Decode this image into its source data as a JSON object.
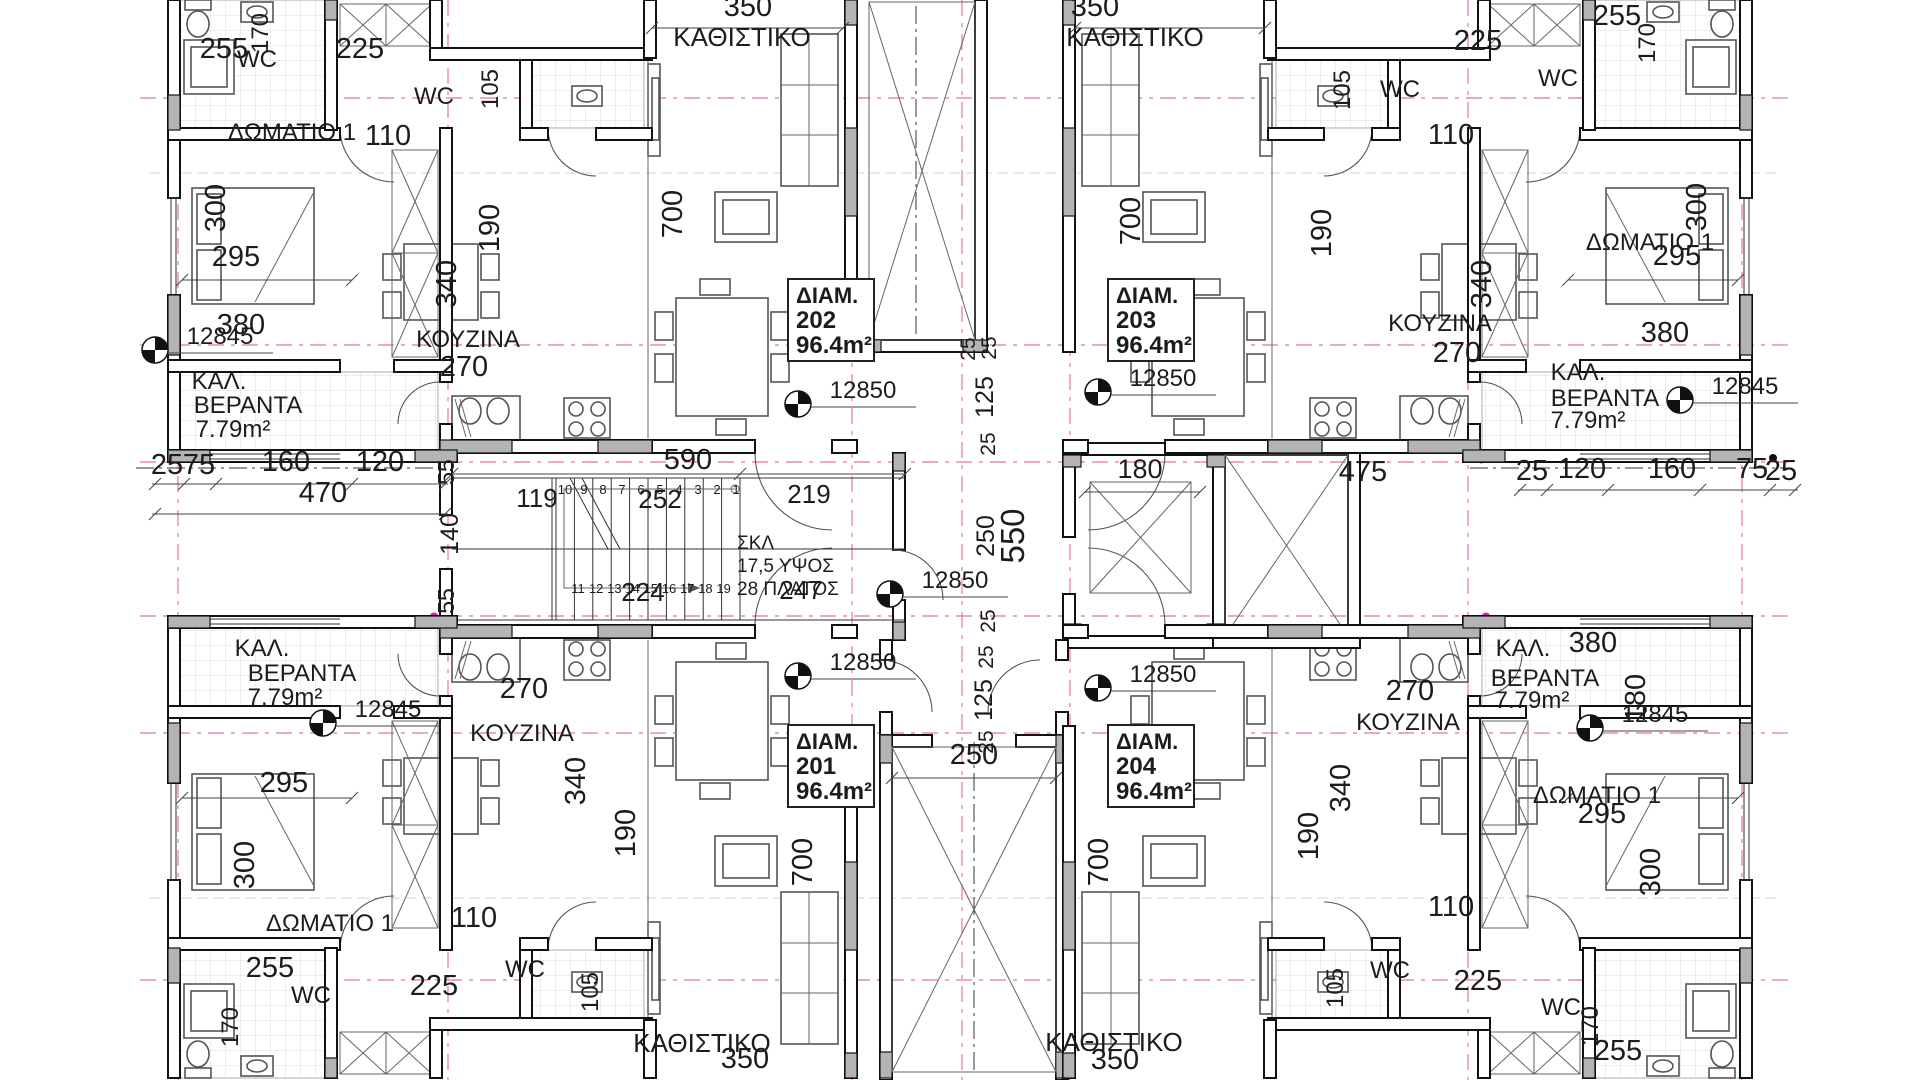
{
  "plan": {
    "type": "architectural-floor-plan",
    "units_note": "dimensions in cm, areas in m2, levels in mm",
    "colors": {
      "wall": "#111111",
      "axis_pink": "#e874ae",
      "wall_fill": "#b4b4b4",
      "paper": "#ffffff",
      "magenta_dot": "#e020c0"
    }
  },
  "apartment_tags": [
    {
      "name": "ΔΙΑΜ.",
      "number": "202",
      "area": "96.4m²",
      "x": 788,
      "y": 279
    },
    {
      "name": "ΔΙΑΜ.",
      "number": "203",
      "area": "96.4m²",
      "x": 1108,
      "y": 279
    },
    {
      "name": "ΔΙΑΜ.",
      "number": "201",
      "area": "96.4m²",
      "x": 788,
      "y": 725
    },
    {
      "name": "ΔΙΑΜ.",
      "number": "204",
      "area": "96.4m²",
      "x": 1108,
      "y": 725
    }
  ],
  "level_markers": [
    {
      "label": "12845",
      "cx": 155,
      "cy": 350
    },
    {
      "label": "12845",
      "cx": 1680,
      "cy": 400
    },
    {
      "label": "12845",
      "cx": 323,
      "cy": 723
    },
    {
      "label": "12845",
      "cx": 1590,
      "cy": 728
    },
    {
      "label": "12850",
      "cx": 798,
      "cy": 404
    },
    {
      "label": "12850",
      "cx": 1098,
      "cy": 392
    },
    {
      "label": "12850",
      "cx": 890,
      "cy": 594
    },
    {
      "label": "12850",
      "cx": 798,
      "cy": 676
    },
    {
      "label": "12850",
      "cx": 1098,
      "cy": 688
    }
  ],
  "stair": {
    "note_lines": [
      "ΣΚΛ",
      "17,5 ΥΨΟΣ",
      "28 ΠΛΑΤΟΣ"
    ],
    "flight1_numbers": [
      "10",
      "9",
      "8",
      "7",
      "6",
      "5",
      "4",
      "3",
      "2",
      "1"
    ],
    "flight2_numbers": [
      "11",
      "12",
      "13",
      "14",
      "15",
      "16",
      "17",
      "18",
      "19"
    ]
  },
  "labels": [
    {
      "t": "350",
      "x": 748,
      "y": 16,
      "s": 29
    },
    {
      "t": "ΚΑΘΙΣΤΙΚΟ",
      "x": 742,
      "y": 46,
      "s": 26
    },
    {
      "t": "350",
      "x": 1095,
      "y": 16,
      "s": 29
    },
    {
      "t": "ΚΑΘΙΣΤΙΚΟ",
      "x": 1135,
      "y": 46,
      "s": 26
    },
    {
      "t": "255",
      "x": 224,
      "y": 58,
      "s": 29
    },
    {
      "t": "WC",
      "x": 257,
      "y": 67,
      "s": 24
    },
    {
      "t": "170",
      "x": 268,
      "y": 33,
      "r": -90,
      "s": 24
    },
    {
      "t": "225",
      "x": 360,
      "y": 58,
      "s": 29
    },
    {
      "t": "105",
      "x": 498,
      "y": 89,
      "r": -90,
      "s": 24
    },
    {
      "t": "WC",
      "x": 434,
      "y": 104,
      "s": 24
    },
    {
      "t": "110",
      "x": 388,
      "y": 145,
      "s": 29
    },
    {
      "t": "ΔΩΜΑΤΙΟ 1",
      "x": 292,
      "y": 140,
      "s": 24
    },
    {
      "t": "300",
      "x": 225,
      "y": 208,
      "r": -90,
      "s": 29
    },
    {
      "t": "295",
      "x": 236,
      "y": 266,
      "s": 29
    },
    {
      "t": "380",
      "x": 241,
      "y": 334,
      "s": 29
    },
    {
      "t": "ΚΑΛ.",
      "x": 219,
      "y": 389,
      "s": 24
    },
    {
      "t": "ΒΕΡΑΝΤΑ",
      "x": 248,
      "y": 413,
      "s": 24
    },
    {
      "t": "7.79m²",
      "x": 233,
      "y": 437,
      "s": 24
    },
    {
      "t": "340",
      "x": 456,
      "y": 284,
      "r": -90,
      "s": 29
    },
    {
      "t": "ΚΟΥΖΙΝΑ",
      "x": 468,
      "y": 347,
      "s": 24
    },
    {
      "t": "270",
      "x": 464,
      "y": 376,
      "s": 29
    },
    {
      "t": "190",
      "x": 499,
      "y": 228,
      "r": -90,
      "s": 29
    },
    {
      "t": "700",
      "x": 682,
      "y": 214,
      "r": -90,
      "s": 29
    },
    {
      "t": "700",
      "x": 1140,
      "y": 221,
      "r": -90,
      "s": 29
    },
    {
      "t": "190",
      "x": 1331,
      "y": 233,
      "r": -90,
      "s": 29
    },
    {
      "t": "340",
      "x": 1491,
      "y": 284,
      "r": -90,
      "s": 29
    },
    {
      "t": "ΚΟΥΖΙΝΑ",
      "x": 1440,
      "y": 331,
      "s": 24
    },
    {
      "t": "270",
      "x": 1457,
      "y": 362,
      "s": 29
    },
    {
      "t": "110",
      "x": 1451,
      "y": 144,
      "s": 29
    },
    {
      "t": "105",
      "x": 1350,
      "y": 90,
      "r": -90,
      "s": 24
    },
    {
      "t": "WC",
      "x": 1400,
      "y": 97,
      "s": 24
    },
    {
      "t": "225",
      "x": 1478,
      "y": 50,
      "s": 29
    },
    {
      "t": "255",
      "x": 1617,
      "y": 25,
      "s": 29
    },
    {
      "t": "WC",
      "x": 1558,
      "y": 86,
      "s": 24
    },
    {
      "t": "170",
      "x": 1655,
      "y": 43,
      "r": -90,
      "s": 24
    },
    {
      "t": "ΔΩΜΑΤΙΟ 1",
      "x": 1650,
      "y": 250,
      "s": 24
    },
    {
      "t": "295",
      "x": 1677,
      "y": 265,
      "s": 29
    },
    {
      "t": "300",
      "x": 1706,
      "y": 207,
      "r": -90,
      "s": 29
    },
    {
      "t": "380",
      "x": 1665,
      "y": 342,
      "s": 29
    },
    {
      "t": "ΚΑΛ.",
      "x": 1578,
      "y": 380,
      "s": 24
    },
    {
      "t": "ΒΕΡΑΝΤΑ",
      "x": 1605,
      "y": 406,
      "s": 24
    },
    {
      "t": "7.79m²",
      "x": 1588,
      "y": 428,
      "s": 24
    },
    {
      "t": "25",
      "x": 975,
      "y": 349,
      "r": -90,
      "s": 21
    },
    {
      "t": "25",
      "x": 996,
      "y": 348,
      "r": -90,
      "s": 21
    },
    {
      "t": "125",
      "x": 993,
      "y": 397,
      "r": -90,
      "s": 25
    },
    {
      "t": "25",
      "x": 995,
      "y": 444,
      "r": -90,
      "s": 21
    },
    {
      "t": "250",
      "x": 994,
      "y": 536,
      "r": -90,
      "s": 25
    },
    {
      "t": "550",
      "x": 1024,
      "y": 536,
      "r": -90,
      "s": 33
    },
    {
      "t": "25",
      "x": 995,
      "y": 621,
      "r": -90,
      "s": 21
    },
    {
      "t": "25",
      "x": 993,
      "y": 657,
      "r": -90,
      "s": 21
    },
    {
      "t": "125",
      "x": 992,
      "y": 700,
      "r": -90,
      "s": 25
    },
    {
      "t": "25",
      "x": 993,
      "y": 742,
      "r": -90,
      "s": 21
    },
    {
      "t": "180",
      "x": 1140,
      "y": 478,
      "s": 27
    },
    {
      "t": "590",
      "x": 688,
      "y": 469,
      "s": 29
    },
    {
      "t": "119",
      "x": 537,
      "y": 507,
      "s": 26
    },
    {
      "t": "252",
      "x": 660,
      "y": 508,
      "s": 26
    },
    {
      "t": "224",
      "x": 643,
      "y": 601,
      "s": 26
    },
    {
      "t": "247",
      "x": 801,
      "y": 599,
      "s": 26
    },
    {
      "t": "219",
      "x": 809,
      "y": 503,
      "s": 26
    },
    {
      "t": "55",
      "x": 454,
      "y": 472,
      "r": -90,
      "s": 23
    },
    {
      "t": "140",
      "x": 458,
      "y": 534,
      "r": -90,
      "s": 25
    },
    {
      "t": "55",
      "x": 454,
      "y": 601,
      "r": -90,
      "s": 23
    },
    {
      "t": "25",
      "x": 167,
      "y": 474,
      "s": 29
    },
    {
      "t": "75",
      "x": 199,
      "y": 474,
      "s": 29
    },
    {
      "t": "160",
      "x": 286,
      "y": 471,
      "s": 29
    },
    {
      "t": "120",
      "x": 380,
      "y": 471,
      "s": 29
    },
    {
      "t": "470",
      "x": 323,
      "y": 502,
      "s": 29
    },
    {
      "t": "25",
      "x": 1532,
      "y": 480,
      "s": 29
    },
    {
      "t": "120",
      "x": 1582,
      "y": 478,
      "s": 29
    },
    {
      "t": "160",
      "x": 1672,
      "y": 478,
      "s": 29
    },
    {
      "t": "75",
      "x": 1752,
      "y": 478,
      "s": 29
    },
    {
      "t": "25",
      "x": 1781,
      "y": 480,
      "s": 29
    },
    {
      "t": "475",
      "x": 1363,
      "y": 481,
      "s": 29
    },
    {
      "t": "270",
      "x": 524,
      "y": 698,
      "s": 29
    },
    {
      "t": "ΚΟΥΖΙΝΑ",
      "x": 522,
      "y": 741,
      "s": 24
    },
    {
      "t": "340",
      "x": 585,
      "y": 781,
      "r": -90,
      "s": 29
    },
    {
      "t": "190",
      "x": 635,
      "y": 833,
      "r": -90,
      "s": 29
    },
    {
      "t": "295",
      "x": 284,
      "y": 792,
      "s": 29
    },
    {
      "t": "300",
      "x": 254,
      "y": 865,
      "r": -90,
      "s": 29
    },
    {
      "t": "ΔΩΜΑΤΙΟ 1",
      "x": 330,
      "y": 931,
      "s": 24
    },
    {
      "t": "255",
      "x": 270,
      "y": 977,
      "s": 29
    },
    {
      "t": "WC",
      "x": 311,
      "y": 1003,
      "s": 24
    },
    {
      "t": "170",
      "x": 238,
      "y": 1027,
      "r": -90,
      "s": 24
    },
    {
      "t": "225",
      "x": 434,
      "y": 995,
      "s": 29
    },
    {
      "t": "110",
      "x": 474,
      "y": 927,
      "s": 29
    },
    {
      "t": "WC",
      "x": 525,
      "y": 977,
      "s": 24
    },
    {
      "t": "105",
      "x": 598,
      "y": 992,
      "r": -90,
      "s": 24
    },
    {
      "t": "ΚΑΛ.",
      "x": 262,
      "y": 656,
      "s": 24
    },
    {
      "t": "ΒΕΡΑΝΤΑ",
      "x": 302,
      "y": 681,
      "s": 24
    },
    {
      "t": "7.79m²",
      "x": 285,
      "y": 705,
      "s": 24
    },
    {
      "t": "ΚΑΘΙΣΤΙΚΟ",
      "x": 702,
      "y": 1052,
      "s": 26
    },
    {
      "t": "350",
      "x": 745,
      "y": 1068,
      "s": 29
    },
    {
      "t": "700",
      "x": 812,
      "y": 862,
      "r": -90,
      "s": 29
    },
    {
      "t": "250",
      "x": 974,
      "y": 764,
      "s": 29
    },
    {
      "t": "ΚΑΘΙΣΤΙΚΟ",
      "x": 1114,
      "y": 1051,
      "s": 26
    },
    {
      "t": "350",
      "x": 1115,
      "y": 1069,
      "s": 29
    },
    {
      "t": "700",
      "x": 1108,
      "y": 862,
      "r": -90,
      "s": 29
    },
    {
      "t": "270",
      "x": 1410,
      "y": 700,
      "s": 29
    },
    {
      "t": "ΚΟΥΖΙΝΑ",
      "x": 1408,
      "y": 730,
      "s": 24
    },
    {
      "t": "340",
      "x": 1350,
      "y": 788,
      "r": -90,
      "s": 29
    },
    {
      "t": "190",
      "x": 1318,
      "y": 836,
      "r": -90,
      "s": 29
    },
    {
      "t": "110",
      "x": 1451,
      "y": 916,
      "s": 29
    },
    {
      "t": "WC",
      "x": 1390,
      "y": 978,
      "s": 24
    },
    {
      "t": "105",
      "x": 1343,
      "y": 988,
      "r": -90,
      "s": 24
    },
    {
      "t": "225",
      "x": 1478,
      "y": 990,
      "s": 29
    },
    {
      "t": "ΔΩΜΑΤΙΟ 1",
      "x": 1597,
      "y": 803,
      "s": 24
    },
    {
      "t": "295",
      "x": 1602,
      "y": 823,
      "s": 29
    },
    {
      "t": "300",
      "x": 1660,
      "y": 872,
      "r": -90,
      "s": 29
    },
    {
      "t": "WC",
      "x": 1561,
      "y": 1015,
      "s": 24
    },
    {
      "t": "170",
      "x": 1598,
      "y": 1026,
      "r": -90,
      "s": 24
    },
    {
      "t": "255",
      "x": 1618,
      "y": 1060,
      "s": 29
    },
    {
      "t": "ΚΑΛ.",
      "x": 1523,
      "y": 656,
      "s": 24
    },
    {
      "t": "ΒΕΡΑΝΤΑ",
      "x": 1545,
      "y": 686,
      "s": 24
    },
    {
      "t": "7.79m²",
      "x": 1532,
      "y": 708,
      "s": 24
    },
    {
      "t": "380",
      "x": 1593,
      "y": 652,
      "s": 29
    },
    {
      "t": "180",
      "x": 1645,
      "y": 698,
      "r": -90,
      "s": 29
    }
  ]
}
